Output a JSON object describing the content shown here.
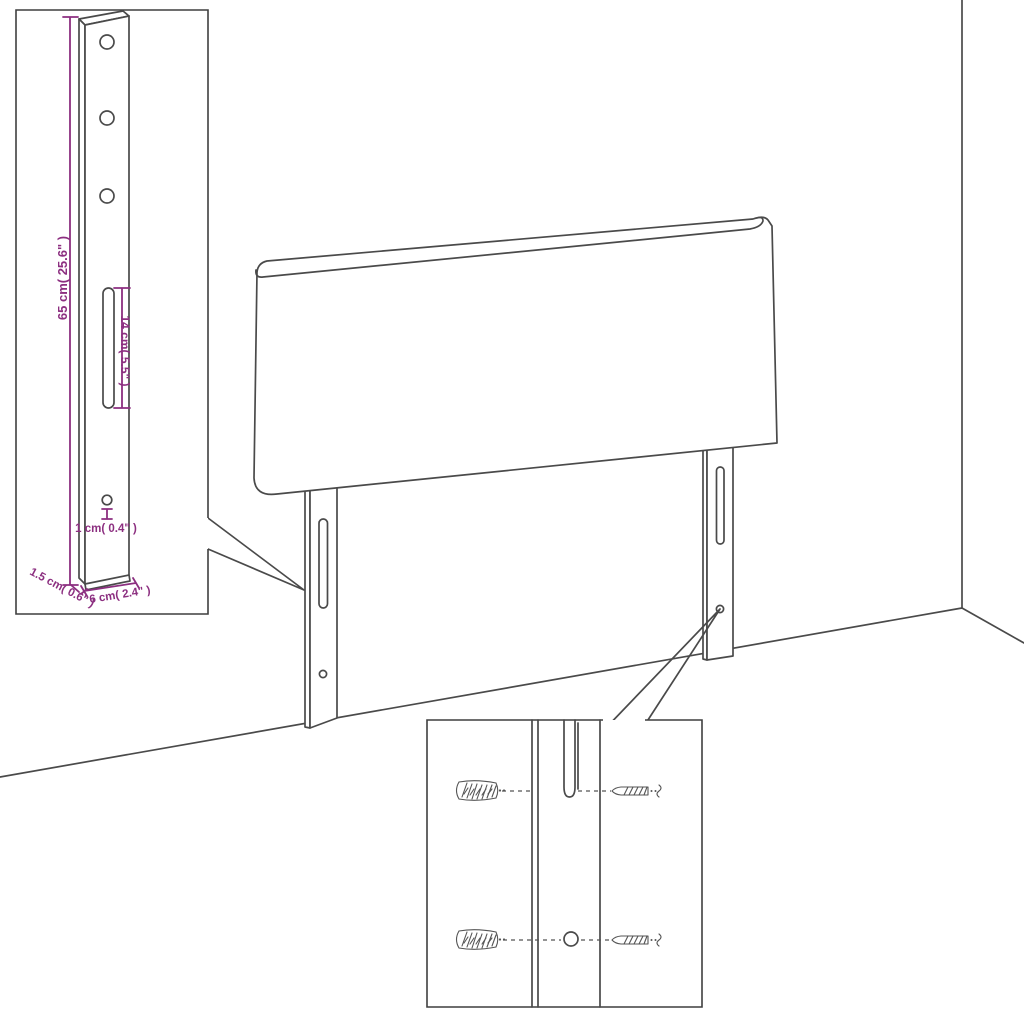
{
  "diagram": {
    "type": "assembly-dimension-diagram",
    "colors": {
      "accent": "#8C2F80",
      "line": "#4A4A4A",
      "inset_border": "#3F3F3F",
      "background": "#FFFFFF"
    },
    "insets": {
      "bracket_detail": {
        "labels": {
          "height": "65 cm( 25.6\" )",
          "slot_length": "14 cm( 5.5\" )",
          "hole": "1 cm( 0.4\" )",
          "depth": "1.5 cm( 0.6\" )",
          "width": "6 cm( 2.4\" )"
        }
      }
    }
  }
}
